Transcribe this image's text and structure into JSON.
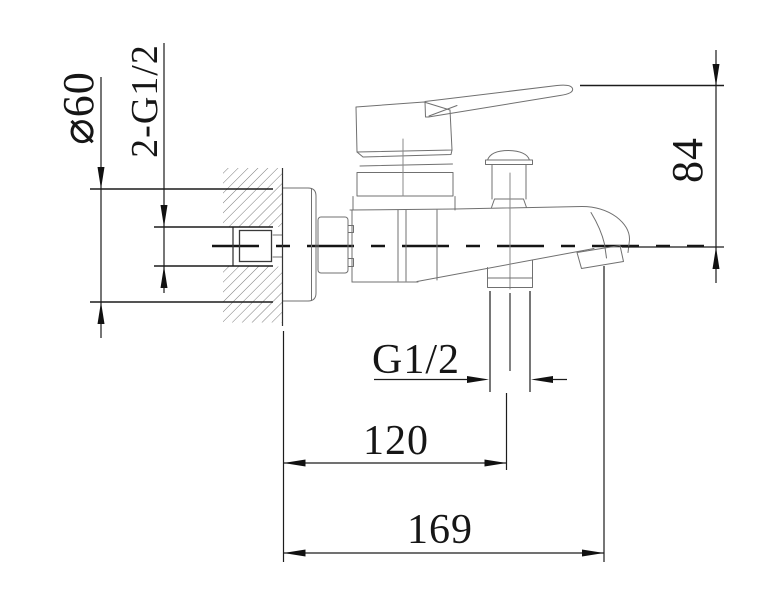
{
  "drawing": {
    "labels": {
      "flange_diameter": "⌀60",
      "inlet_thread": "2-G1/2",
      "spout_height": "84",
      "outlet_thread": "G1/2",
      "wall_to_outlet": "120",
      "wall_to_spout_tip": "169"
    },
    "colors": {
      "dimension_line": "#1c1c1c",
      "outline": "#707070",
      "hatch": "#6b6b6b",
      "background": "#ffffff"
    }
  }
}
